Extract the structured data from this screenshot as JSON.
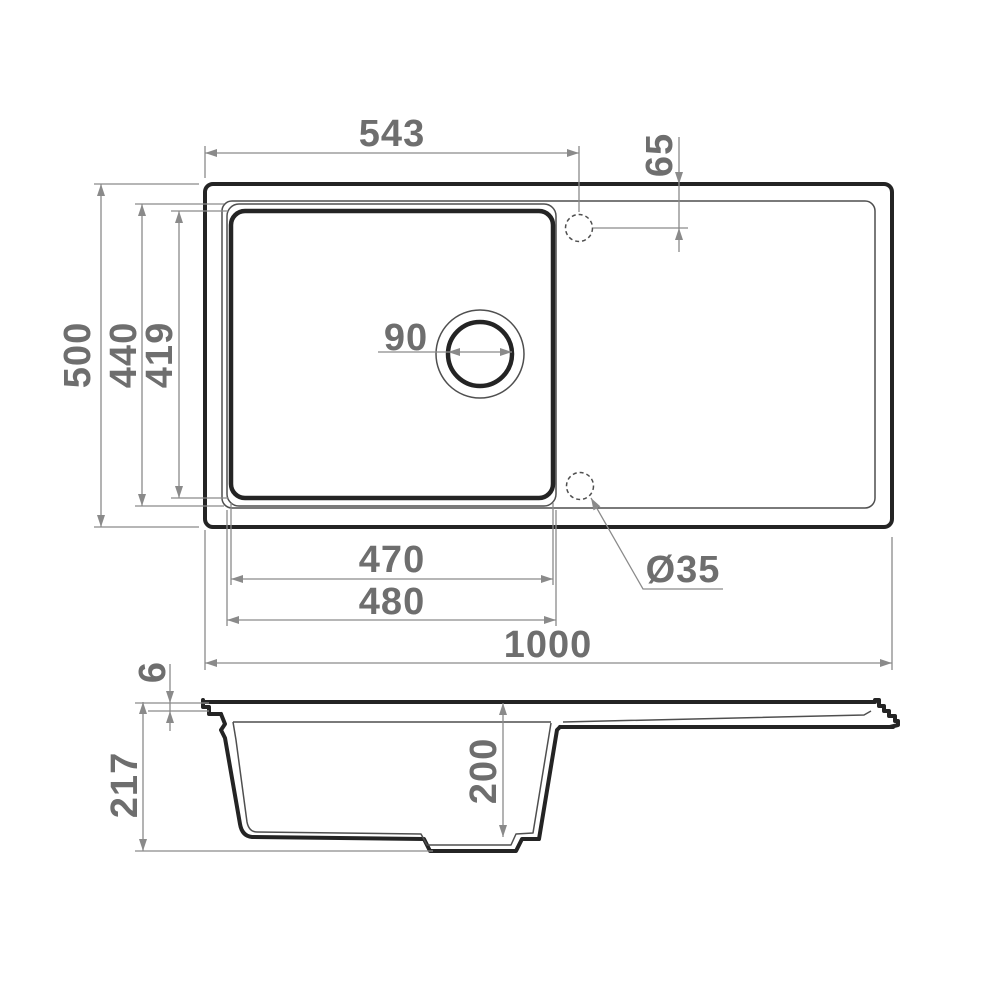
{
  "drawing": {
    "type": "technical-drawing",
    "subject": "Kitchen sink with drainboard - dimensioned plan view and cross-section view",
    "colors": {
      "background": "#ffffff",
      "line_dark": "#242424",
      "line_thin": "#4f4f4f",
      "dim_line": "#8a8a8a",
      "label_text": "#6e6e6e"
    },
    "plan_view": {
      "labels": {
        "faucet_offset_x": "543",
        "faucet_offset_y": "65",
        "overall_depth": "500",
        "bowl_outer_depth": "440",
        "bowl_inner_depth": "419",
        "drain_diameter": "90",
        "bowl_inner_width": "470",
        "bowl_outer_width": "480",
        "overall_width": "1000",
        "faucet_hole_diameter": "Ø35"
      }
    },
    "section_view": {
      "labels": {
        "rim_thickness": "6",
        "overall_height": "217",
        "bowl_depth": "200"
      }
    }
  }
}
